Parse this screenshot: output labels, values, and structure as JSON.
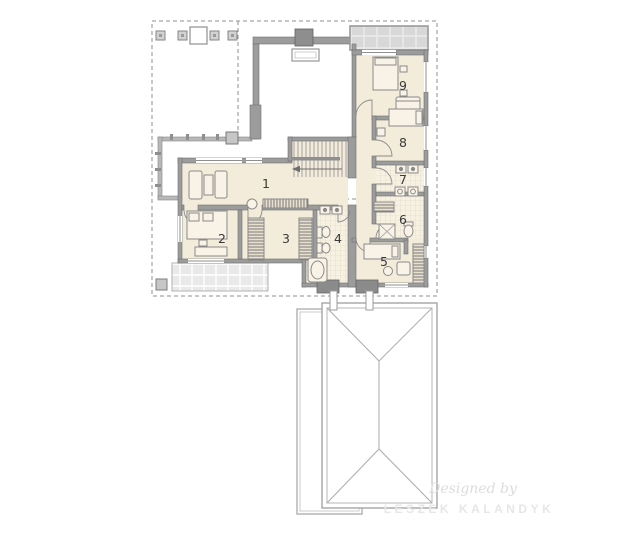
{
  "plan": {
    "rooms": [
      {
        "label": "1"
      },
      {
        "label": "2"
      },
      {
        "label": "3"
      },
      {
        "label": "4"
      },
      {
        "label": "5"
      },
      {
        "label": "6"
      },
      {
        "label": "7"
      },
      {
        "label": "8"
      },
      {
        "label": "9"
      }
    ],
    "watermark": {
      "line1": "Designed by",
      "line2": "LESZEK KALANDYK"
    },
    "colors": {
      "floor": "#f3ecdb",
      "wall": "#9c9c9c",
      "wall_outline": "#6f6f6f",
      "terrace_tile": "#d8d8d8",
      "lower_terrace_tile": "#e9e9e9",
      "bath_tile_line": "#d9d2bf",
      "dashed_line": "#8f8f8f",
      "roof_line": "#a8a8a8",
      "room_label": "#3a3a3a",
      "watermark": "#e2e2e2"
    }
  }
}
